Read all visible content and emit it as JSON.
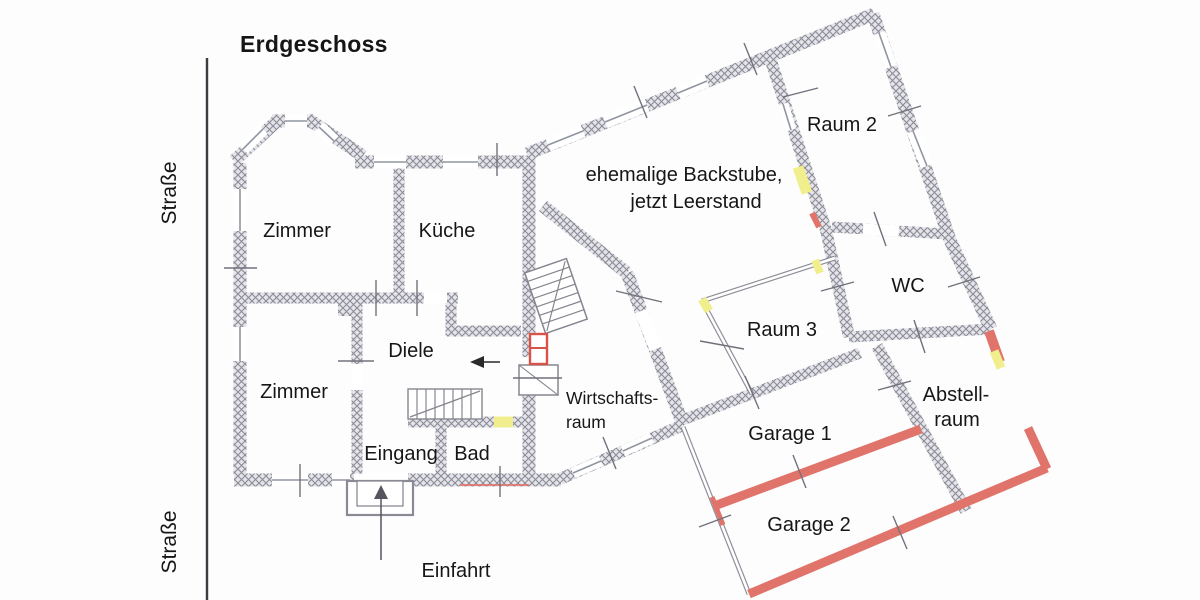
{
  "title": "Erdgeschoss",
  "street": {
    "label_top": "Straße",
    "label_bottom": "Straße"
  },
  "outside": {
    "driveway": "Einfahrt"
  },
  "rooms": {
    "zimmer_top": "Zimmer",
    "kueche": "Küche",
    "zimmer_bottom": "Zimmer",
    "diele": "Diele",
    "eingang": "Eingang",
    "bad": "Bad",
    "wirtschaftsraum_line1": "Wirtschafts-",
    "wirtschaftsraum_line2": "raum",
    "backstube_line1": "ehemalige Backstube,",
    "backstube_line2": "jetzt Leerstand",
    "raum2": "Raum 2",
    "raum3": "Raum 3",
    "wc": "WC",
    "garage1": "Garage 1",
    "garage2": "Garage 2",
    "abstellraum_line1": "Abstell-",
    "abstellraum_line2": "raum"
  },
  "colors": {
    "wall_hatch_line": "#8b8b95",
    "wall_hatch_bg": "#e4e4ea",
    "new_wall_red": "#e0746b",
    "window_yellow": "#f1ee8e",
    "street_line": "#3c3c42",
    "text": "#161616",
    "background": "#fdfdfe"
  }
}
